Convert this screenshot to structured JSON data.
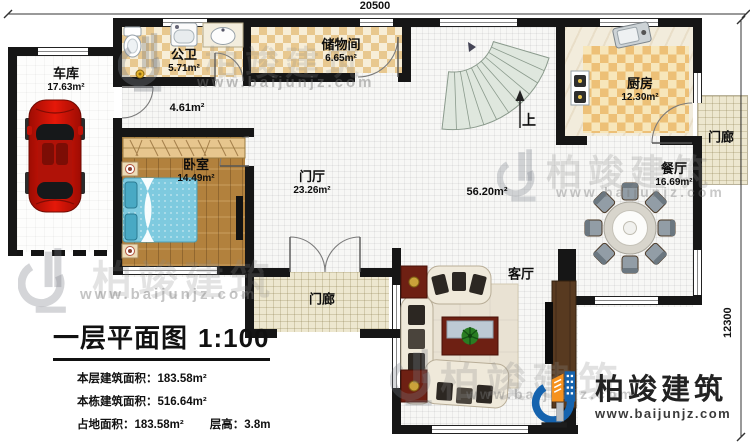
{
  "dimensions": {
    "top": "20500",
    "right": "12300"
  },
  "rooms": {
    "garage": {
      "name": "车库",
      "area": "17.63m²"
    },
    "bathroom": {
      "name": "公卫",
      "area": "5.71m²"
    },
    "storage": {
      "name": "储物间",
      "area": "6.65m²"
    },
    "hall": {
      "area": "4.61m²"
    },
    "bedroom": {
      "name": "卧室",
      "area": "14.49m²"
    },
    "foyer": {
      "name": "门厅",
      "area": "23.26m²"
    },
    "open_area": {
      "area": "56.20m²"
    },
    "kitchen": {
      "name": "厨房",
      "area": "12.30m²"
    },
    "dining": {
      "name": "餐厅",
      "area": "16.69m²"
    },
    "living": {
      "name": "客厅"
    },
    "porch_side": {
      "name": "门廊"
    },
    "porch_front": {
      "name": "门廊"
    },
    "stairs": {
      "up": "上"
    }
  },
  "title_block": {
    "title": "一层平面图",
    "scale": "1:100",
    "stats": [
      {
        "label": "本层建筑面积：",
        "value": "183.58m²"
      },
      {
        "label": "本栋建筑面积：",
        "value": "516.64m²"
      },
      {
        "label": "占地面积：",
        "value": "183.58m²"
      },
      {
        "label": "层高：",
        "value": "3.8m"
      }
    ]
  },
  "brand": {
    "name": "柏竣建筑",
    "url": "www.baijunjz.com"
  },
  "watermark": {
    "name": "柏竣建筑",
    "url": "www.baijunjz.com"
  },
  "colors": {
    "wall": "#161616",
    "checker_tan": "#e8c88f",
    "checker_light": "#f7eed8",
    "kitchen_checker": "#edc077",
    "wood_floor": "#b2813d",
    "bed_blue": "#7ecadf",
    "stair_green": "#dfe7de",
    "car_red": "#cf1407",
    "porch_floor": "#ede7cf",
    "logo_blue": "#1563ae",
    "logo_orange": "#f6921e"
  }
}
